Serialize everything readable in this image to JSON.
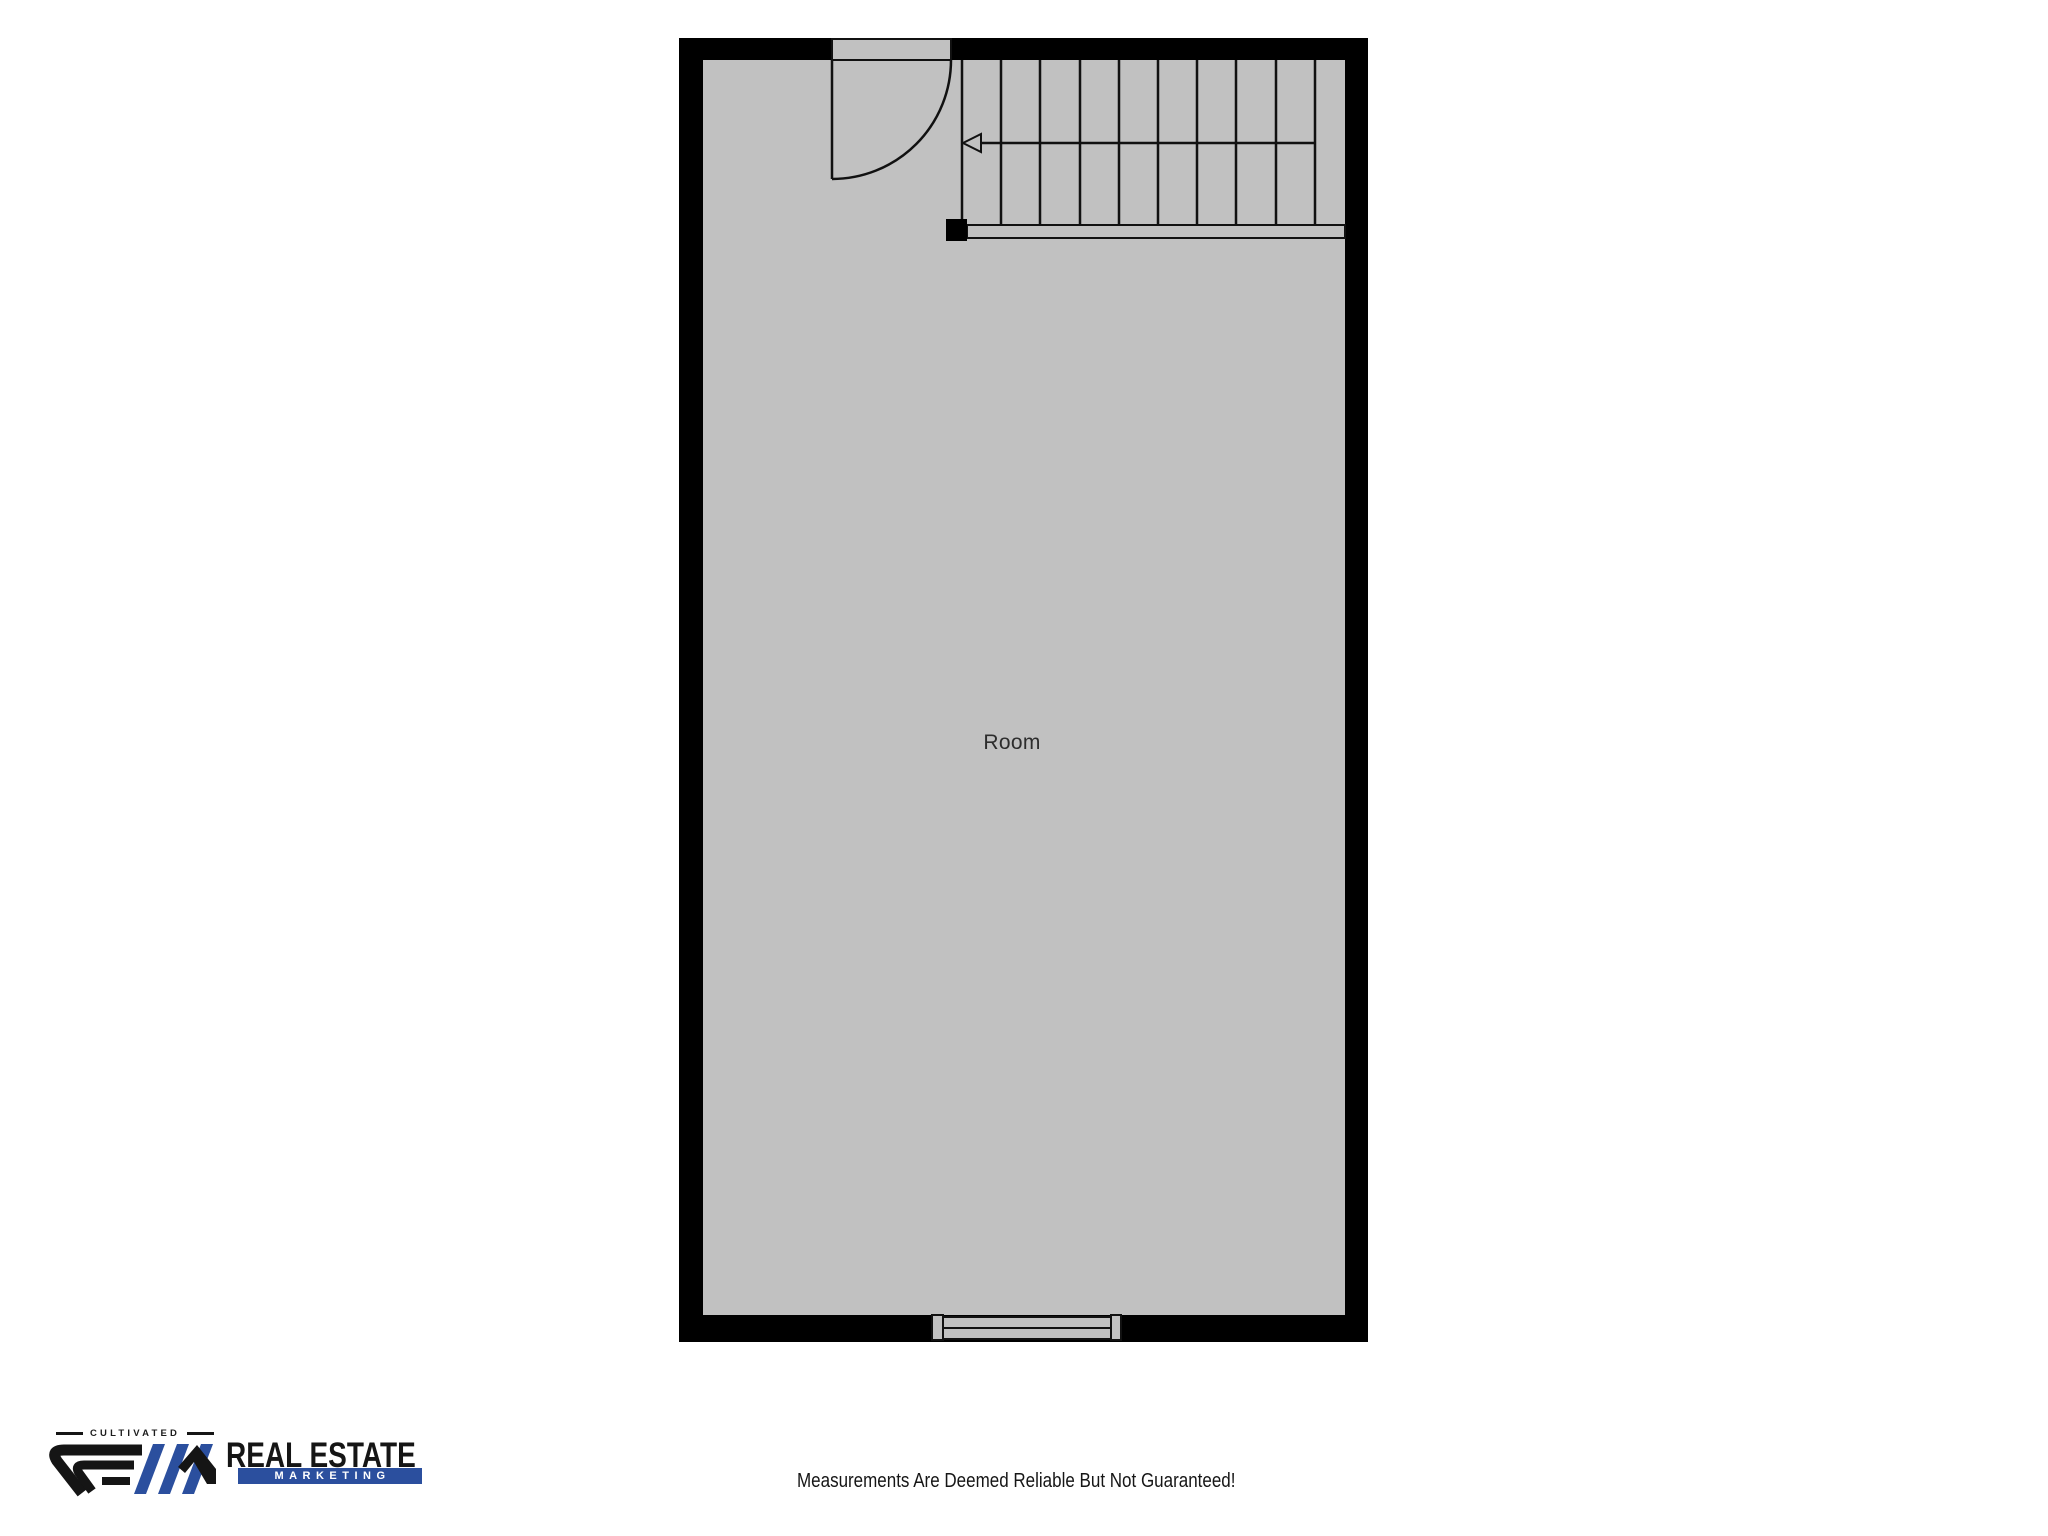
{
  "page": {
    "background_color": "#ffffff"
  },
  "floor_plan": {
    "room_label": "Room",
    "colors": {
      "wall": "#000000",
      "floor": "#c1c1c1",
      "outline": "#111111"
    },
    "stairs": {
      "tread_count": 10,
      "arrow_direction": "left"
    }
  },
  "footer": {
    "logo": {
      "tagline": "CULTIVATED",
      "name_line1": "REAL ESTATE",
      "name_line2": "MARKETING",
      "brand_blue": "#2b4f9e",
      "brand_black": "#151515"
    },
    "disclaimer": "Measurements Are Deemed Reliable But Not Guaranteed!"
  }
}
